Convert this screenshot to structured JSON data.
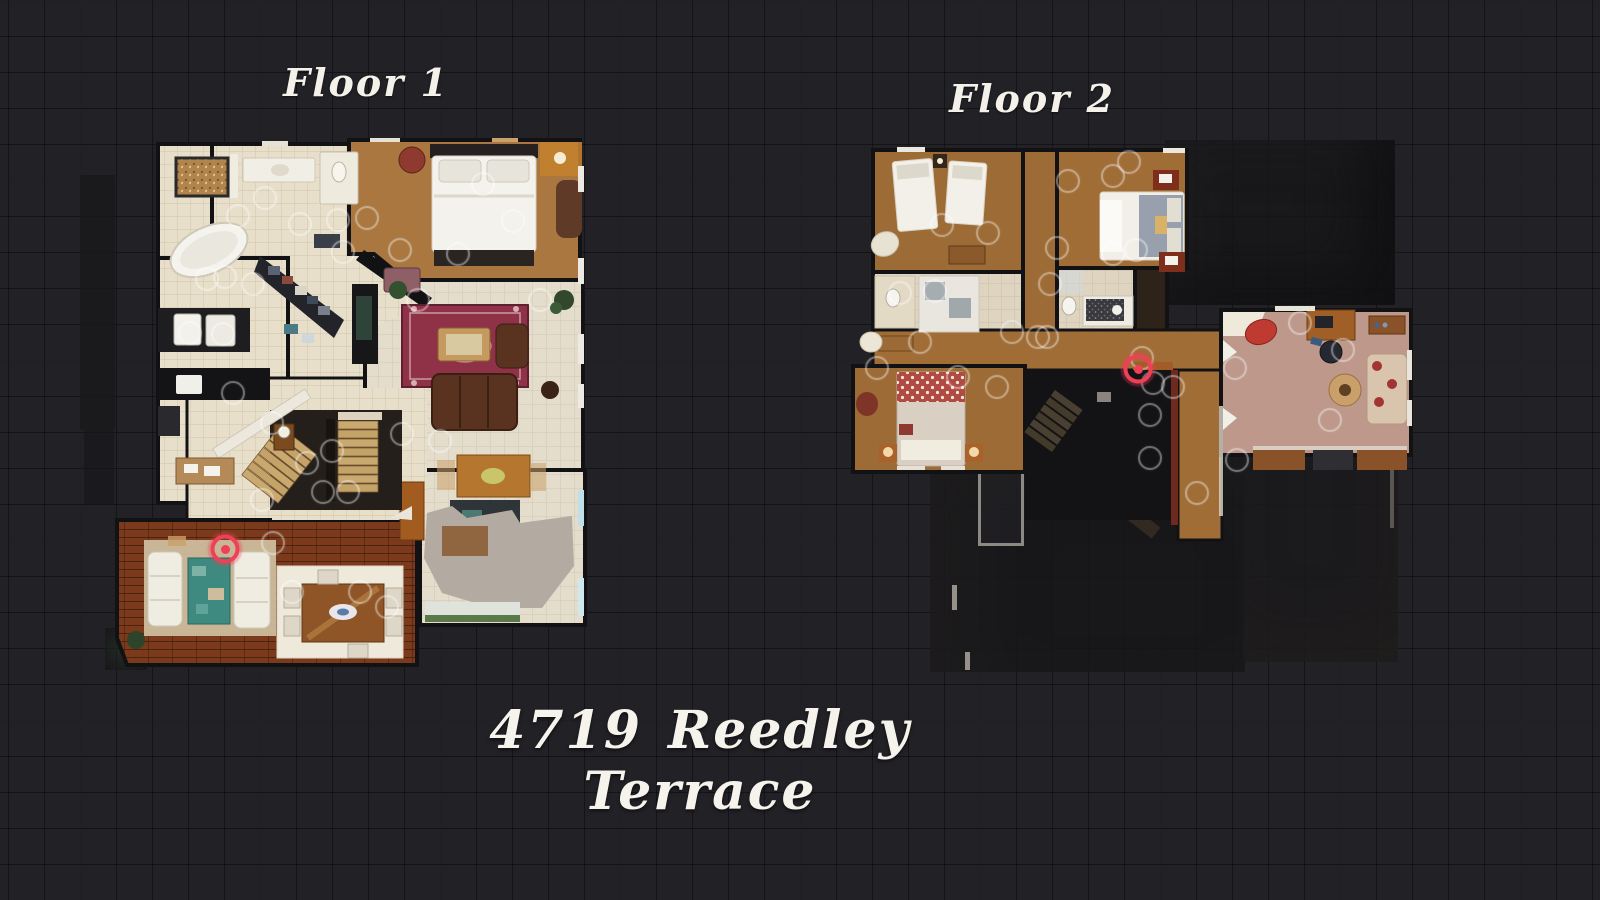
{
  "scene": {
    "background_color": "#212126",
    "label_color": "#f4f1ea"
  },
  "address": {
    "text": "4719 Reedley Terrace"
  },
  "floors": [
    {
      "label": "Floor 1",
      "marker": {
        "x": 225,
        "y": 549
      },
      "sweeps": [
        [
          238,
          216
        ],
        [
          265,
          198
        ],
        [
          300,
          224
        ],
        [
          338,
          220
        ],
        [
          367,
          218
        ],
        [
          400,
          250
        ],
        [
          458,
          254
        ],
        [
          483,
          184
        ],
        [
          513,
          221
        ],
        [
          540,
          300
        ],
        [
          225,
          277
        ],
        [
          207,
          279
        ],
        [
          253,
          284
        ],
        [
          190,
          333
        ],
        [
          223,
          334
        ],
        [
          233,
          393
        ],
        [
          272,
          423
        ],
        [
          307,
          463
        ],
        [
          332,
          451
        ],
        [
          323,
          492
        ],
        [
          348,
          492
        ],
        [
          262,
          500
        ],
        [
          273,
          543
        ],
        [
          292,
          592
        ],
        [
          360,
          592
        ],
        [
          387,
          607
        ],
        [
          402,
          434
        ],
        [
          440,
          441
        ],
        [
          343,
          252
        ],
        [
          418,
          300
        ]
      ]
    },
    {
      "label": "Floor 2",
      "marker": {
        "x": 1138,
        "y": 369
      },
      "sweeps": [
        [
          942,
          225
        ],
        [
          988,
          233
        ],
        [
          1068,
          181
        ],
        [
          1113,
          176
        ],
        [
          1129,
          162
        ],
        [
          1057,
          248
        ],
        [
          1050,
          284
        ],
        [
          1113,
          254
        ],
        [
          1136,
          250
        ],
        [
          900,
          293
        ],
        [
          935,
          291
        ],
        [
          1012,
          332
        ],
        [
          1038,
          337
        ],
        [
          1047,
          337
        ],
        [
          920,
          342
        ],
        [
          877,
          368
        ],
        [
          958,
          377
        ],
        [
          997,
          387
        ],
        [
          1142,
          358
        ],
        [
          1153,
          383
        ],
        [
          1173,
          387
        ],
        [
          1150,
          415
        ],
        [
          1235,
          368
        ],
        [
          1300,
          323
        ],
        [
          1343,
          350
        ],
        [
          1237,
          460
        ],
        [
          1150,
          458
        ],
        [
          1197,
          493
        ],
        [
          1330,
          420
        ]
      ]
    }
  ],
  "colors": {
    "marker_red": "#ee4057",
    "sweep_ring": "rgba(255,255,255,0.38)"
  }
}
